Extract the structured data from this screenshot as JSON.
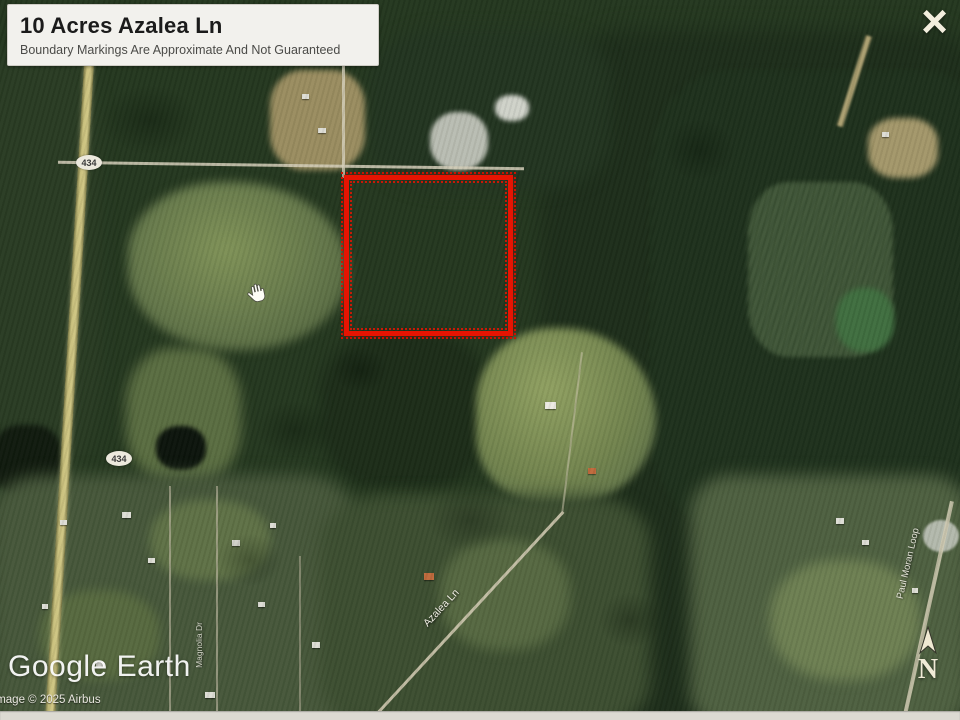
{
  "viewer": {
    "close_label": "×"
  },
  "overlay_card": {
    "title": "10 Acres Azalea Ln",
    "subtitle": "Boundary Markings Are Approximate And Not Guaranteed"
  },
  "map": {
    "road_shields": [
      {
        "label": "434"
      },
      {
        "label": "434"
      }
    ],
    "street_labels": [
      {
        "text": "Azalea Ln"
      },
      {
        "text": "Paul Moran Loop"
      },
      {
        "text": "Magnolia Dr"
      }
    ],
    "north_indicator": "N",
    "parcel_color": "#e61402"
  },
  "watermark": {
    "brand": "Google Earth",
    "copyright": "Image © 2025 Airbus"
  },
  "colors": {
    "parcel_red": "#e61402",
    "forest_dark": "#1d2d1a",
    "field_green": "#7f9257",
    "road_tan": "#c9c07c",
    "card_bg": "#f2f1ed"
  }
}
